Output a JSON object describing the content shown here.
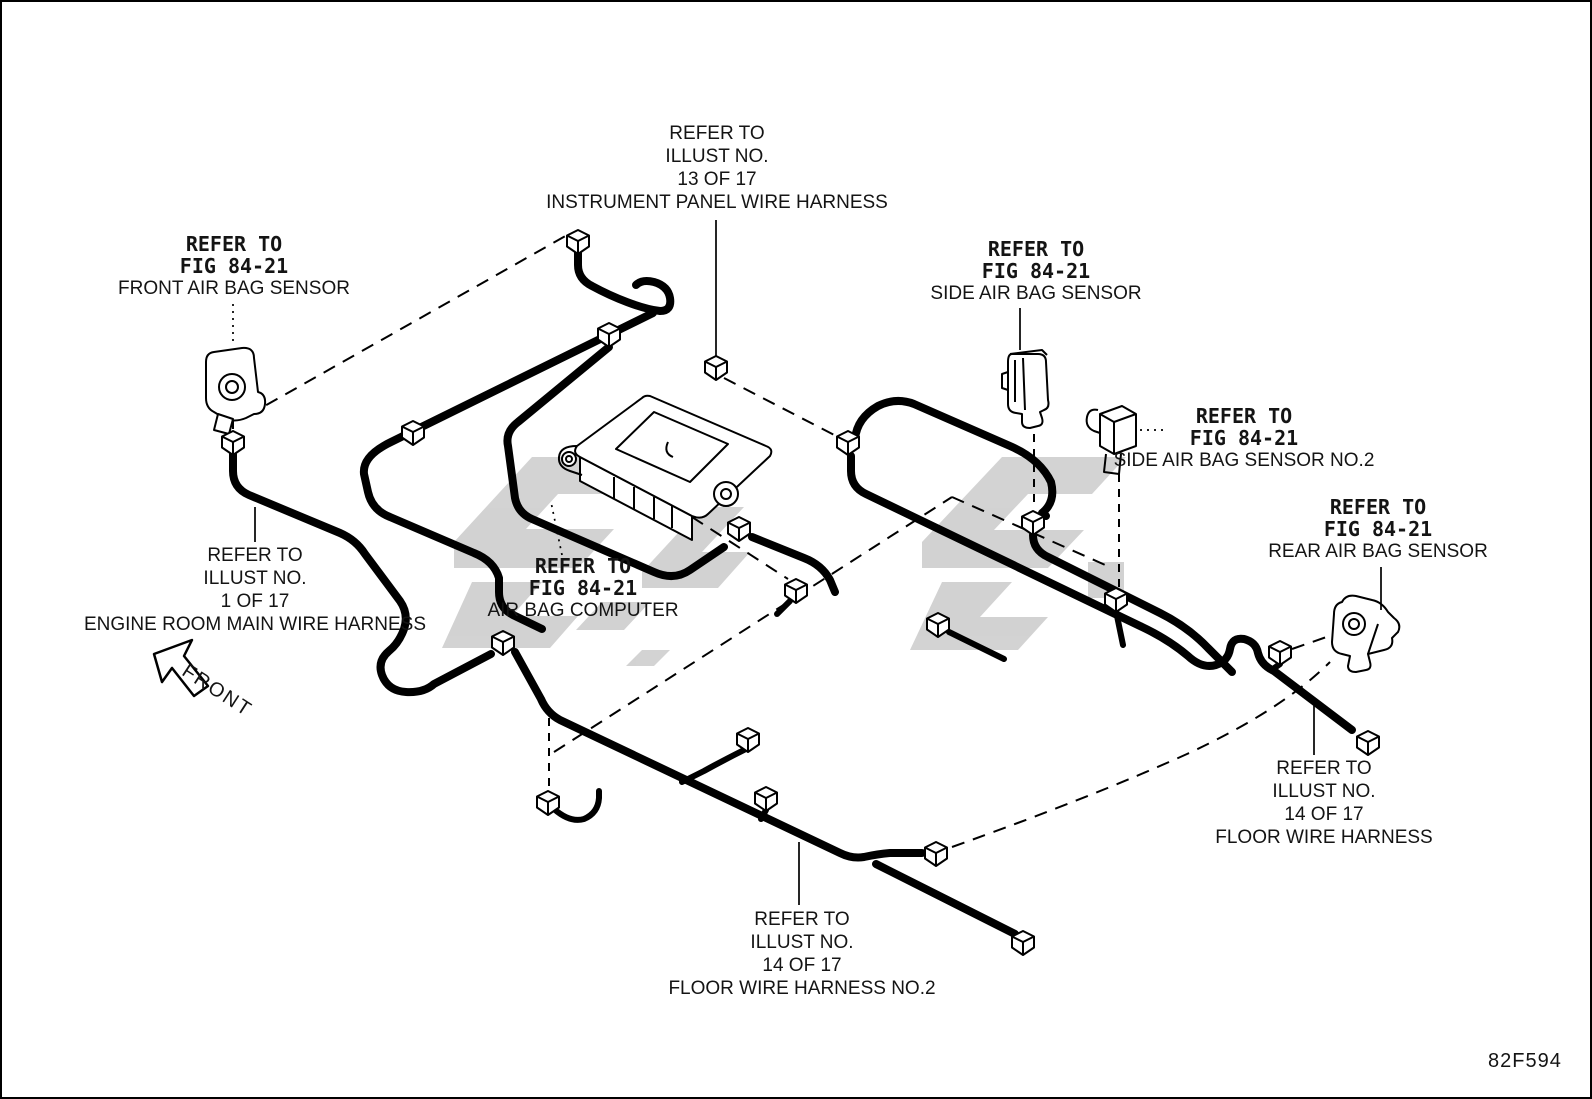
{
  "figure_code": "82F594",
  "front_indicator": "FRONT",
  "callouts": {
    "instrument_panel": {
      "lines": [
        "REFER TO",
        "ILLUST NO.",
        "13 OF 17",
        "INSTRUMENT PANEL WIRE HARNESS"
      ]
    },
    "front_air_bag_sensor": {
      "lines": [
        "REFER TO",
        "FIG 84-21",
        "FRONT AIR BAG SENSOR"
      ]
    },
    "side_air_bag_sensor": {
      "lines": [
        "REFER TO",
        "FIG 84-21",
        "SIDE AIR BAG SENSOR"
      ]
    },
    "side_air_bag_sensor_no2": {
      "lines": [
        "REFER TO",
        "FIG 84-21",
        "SIDE AIR BAG SENSOR NO.2"
      ]
    },
    "rear_air_bag_sensor": {
      "lines": [
        "REFER TO",
        "FIG 84-21",
        "REAR AIR BAG SENSOR"
      ]
    },
    "engine_room_main": {
      "lines": [
        "REFER TO",
        "ILLUST NO.",
        "1 OF 17",
        "ENGINE ROOM MAIN WIRE HARNESS"
      ]
    },
    "air_bag_computer": {
      "lines": [
        "REFER TO",
        "FIG 84-21",
        "AIR BAG COMPUTER"
      ]
    },
    "floor": {
      "lines": [
        "REFER TO",
        "ILLUST NO.",
        "14 OF 17",
        "FLOOR WIRE HARNESS"
      ]
    },
    "floor_no2": {
      "lines": [
        "REFER TO",
        "ILLUST NO.",
        "14 OF 17",
        "FLOOR WIRE HARNESS NO.2"
      ]
    }
  },
  "colors": {
    "ink": "#000000",
    "watermark": "#c8c8c8",
    "background": "#ffffff"
  }
}
